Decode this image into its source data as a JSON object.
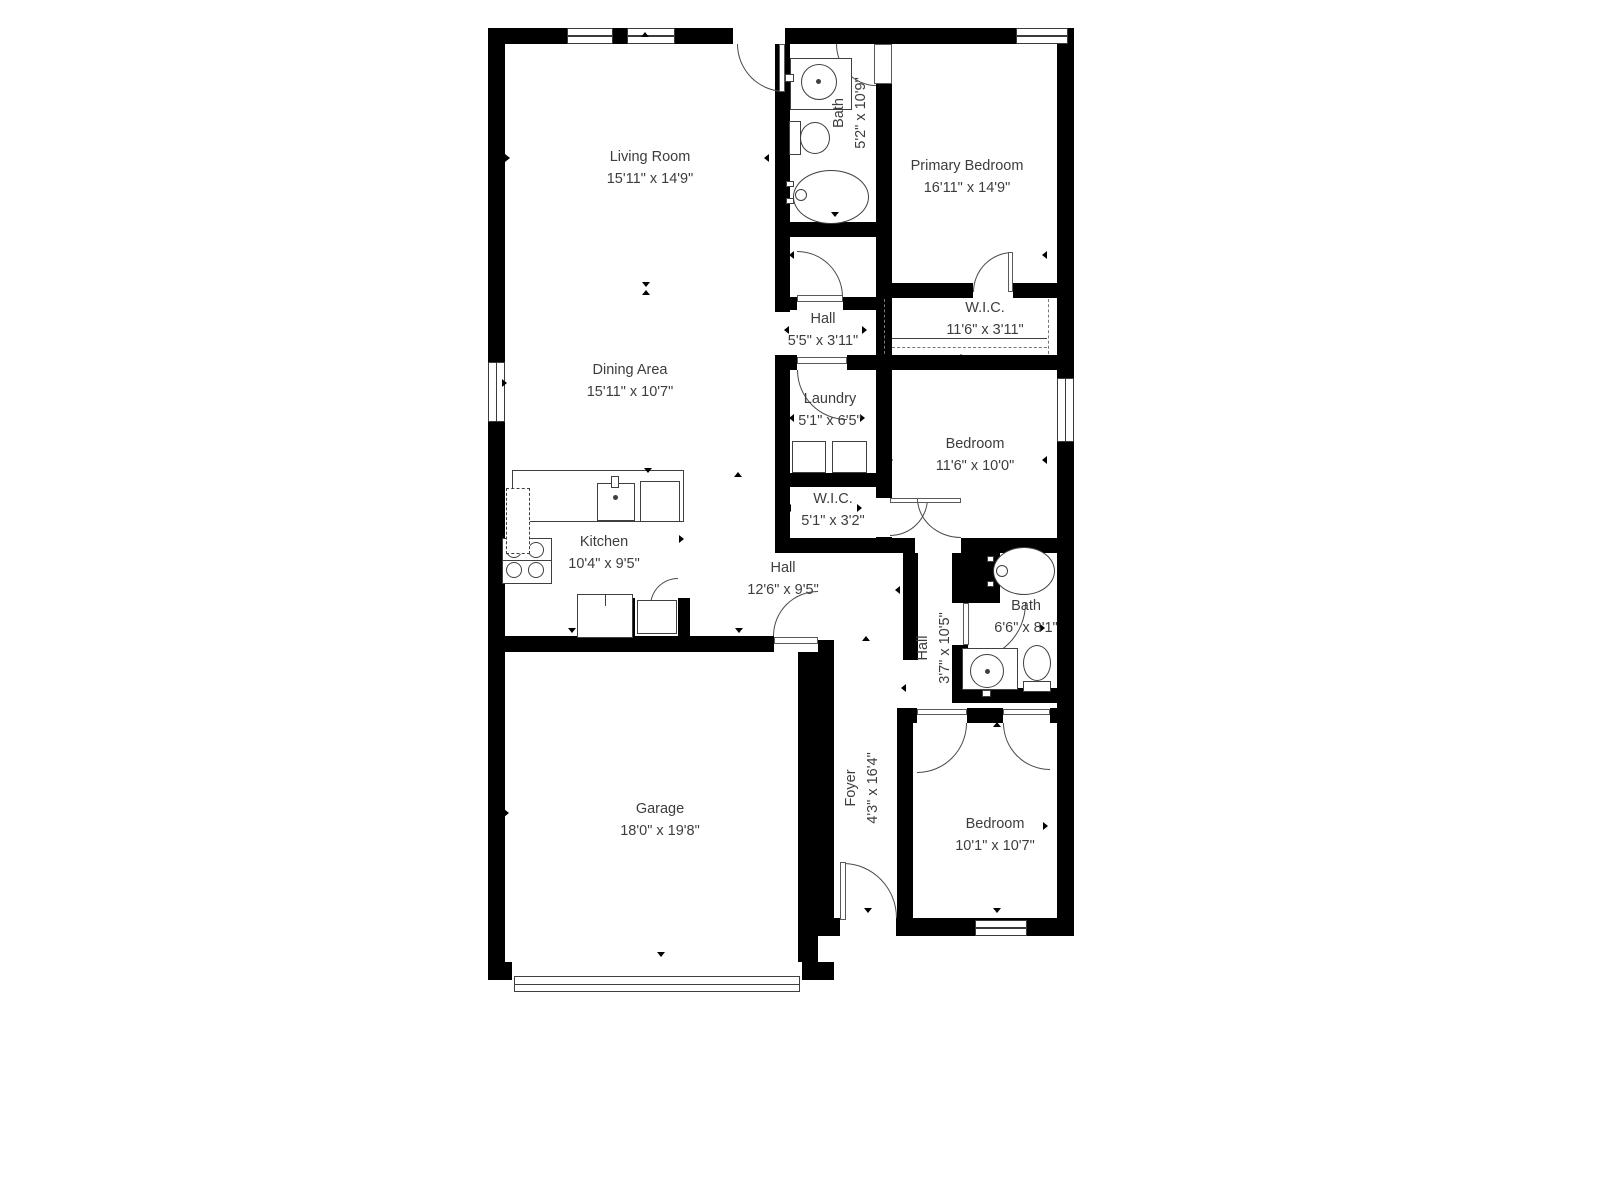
{
  "colors": {
    "wall": "#000000",
    "fixture_line": "#3f3f3f",
    "text": "#3d3d3d",
    "background": "#ffffff"
  },
  "floorplan": {
    "rooms": [
      {
        "name": "Living Room",
        "dims": "15'11\" x 14'9\"",
        "x": 650,
        "y": 168,
        "rot": 0
      },
      {
        "name": "Bath",
        "dims": "5'2\" x 10'9\"",
        "x": 850,
        "y": 113,
        "rot": -90
      },
      {
        "name": "Primary Bedroom",
        "dims": "16'11\" x 14'9\"",
        "x": 967,
        "y": 177,
        "rot": 0
      },
      {
        "name": "Hall",
        "dims": "5'5\" x 3'11\"",
        "x": 823,
        "y": 330,
        "rot": 0
      },
      {
        "name": "W.I.C.",
        "dims": "11'6\" x 3'11\"",
        "x": 985,
        "y": 319,
        "rot": 0
      },
      {
        "name": "Dining Area",
        "dims": "15'11\" x 10'7\"",
        "x": 630,
        "y": 381,
        "rot": 0
      },
      {
        "name": "Laundry",
        "dims": "5'1\" x 6'5\"",
        "x": 830,
        "y": 410,
        "rot": 0
      },
      {
        "name": "Bedroom",
        "dims": "11'6\" x 10'0\"",
        "x": 975,
        "y": 455,
        "rot": 0
      },
      {
        "name": "W.I.C.",
        "dims": "5'1\" x 3'2\"",
        "x": 833,
        "y": 510,
        "rot": 0
      },
      {
        "name": "Kitchen",
        "dims": "10'4\" x 9'5\"",
        "x": 604,
        "y": 553,
        "rot": 0
      },
      {
        "name": "Hall",
        "dims": "12'6\" x 9'5\"",
        "x": 783,
        "y": 579,
        "rot": 0
      },
      {
        "name": "Hall",
        "dims": "3'7\" x 10'5\"",
        "x": 934,
        "y": 648,
        "rot": -90
      },
      {
        "name": "Bath",
        "dims": "6'6\" x 8'1\"",
        "x": 1026,
        "y": 617,
        "rot": 0
      },
      {
        "name": "Garage",
        "dims": "18'0\" x 19'8\"",
        "x": 660,
        "y": 820,
        "rot": 0
      },
      {
        "name": "Foyer",
        "dims": "4'3\" x 16'4\"",
        "x": 862,
        "y": 788,
        "rot": -90
      },
      {
        "name": "Bedroom",
        "dims": "10'1\" x 10'7\"",
        "x": 995,
        "y": 835,
        "rot": 0
      }
    ],
    "walls": [
      [
        488,
        28,
        586,
        16
      ],
      [
        488,
        28,
        17,
        952
      ],
      [
        1057,
        28,
        17,
        908
      ],
      [
        488,
        962,
        346,
        18
      ],
      [
        818,
        918,
        256,
        18
      ],
      [
        775,
        44,
        15,
        268
      ],
      [
        775,
        370,
        15,
        175
      ],
      [
        775,
        355,
        282,
        15
      ],
      [
        775,
        222,
        117,
        15
      ],
      [
        876,
        84,
        16,
        414
      ],
      [
        876,
        537,
        16,
        16
      ],
      [
        790,
        297,
        86,
        13
      ],
      [
        876,
        283,
        181,
        15
      ],
      [
        775,
        473,
        117,
        14
      ],
      [
        775,
        538,
        101,
        15
      ],
      [
        876,
        538,
        181,
        15
      ],
      [
        903,
        553,
        15,
        107
      ],
      [
        952,
        545,
        48,
        58
      ],
      [
        952,
        645,
        16,
        58
      ],
      [
        952,
        688,
        105,
        15
      ],
      [
        897,
        708,
        160,
        15
      ],
      [
        897,
        708,
        16,
        212
      ],
      [
        818,
        640,
        16,
        280
      ],
      [
        798,
        652,
        20,
        310
      ],
      [
        505,
        636,
        313,
        16
      ],
      [
        623,
        598,
        12,
        38
      ],
      [
        678,
        598,
        12,
        38
      ]
    ],
    "openings": [
      [
        733,
        28,
        52,
        16
      ],
      [
        973,
        283,
        40,
        15
      ],
      [
        797,
        297,
        46,
        13
      ],
      [
        797,
        355,
        50,
        15
      ],
      [
        915,
        538,
        46,
        15
      ],
      [
        774,
        636,
        44,
        16
      ],
      [
        917,
        708,
        50,
        15
      ],
      [
        1003,
        708,
        47,
        15
      ],
      [
        840,
        918,
        56,
        18
      ],
      [
        512,
        962,
        290,
        18
      ]
    ],
    "windows": [
      [
        567,
        28,
        46,
        16
      ],
      [
        627,
        28,
        48,
        16
      ],
      [
        1016,
        28,
        52,
        16
      ],
      [
        488,
        362,
        17,
        60
      ],
      [
        1057,
        378,
        17,
        64
      ],
      [
        975,
        920,
        52,
        16
      ]
    ],
    "doors": [
      {
        "x": 737,
        "y": 44,
        "w": 48,
        "h": 48,
        "c": "bl"
      },
      {
        "x": 836,
        "y": 44,
        "w": 40,
        "h": 42,
        "c": "bl"
      },
      {
        "x": 973,
        "y": 252,
        "w": 40,
        "h": 40,
        "c": "tl"
      },
      {
        "x": 797,
        "y": 251,
        "w": 46,
        "h": 46,
        "c": "tr"
      },
      {
        "x": 797,
        "y": 370,
        "w": 50,
        "h": 50,
        "c": "bl"
      },
      {
        "x": 890,
        "y": 498,
        "w": 38,
        "h": 38,
        "c": "br"
      },
      {
        "x": 917,
        "y": 498,
        "w": 44,
        "h": 40,
        "c": "bl"
      },
      {
        "x": 773,
        "y": 591,
        "w": 45,
        "h": 45,
        "c": "tl"
      },
      {
        "x": 650,
        "y": 578,
        "w": 28,
        "h": 28,
        "c": "tl"
      },
      {
        "x": 968,
        "y": 603,
        "w": 58,
        "h": 58,
        "c": "br"
      },
      {
        "x": 917,
        "y": 723,
        "w": 50,
        "h": 50,
        "c": "br"
      },
      {
        "x": 1003,
        "y": 723,
        "w": 47,
        "h": 47,
        "c": "bl"
      },
      {
        "x": 843,
        "y": 863,
        "w": 54,
        "h": 55,
        "c": "tr"
      }
    ],
    "leaves": [
      [
        779,
        44,
        6,
        48
      ],
      [
        874,
        44,
        18,
        40
      ],
      [
        1008,
        252,
        5,
        40
      ],
      [
        797,
        295,
        46,
        7
      ],
      [
        797,
        357,
        50,
        7
      ],
      [
        890,
        498,
        38,
        5
      ],
      [
        917,
        498,
        44,
        5
      ],
      [
        774,
        637,
        44,
        7
      ],
      [
        963,
        603,
        6,
        42
      ],
      [
        840,
        862,
        6,
        58
      ],
      [
        917,
        709,
        50,
        6
      ],
      [
        1003,
        709,
        47,
        6
      ]
    ],
    "fixtures": [
      {
        "t": "rect",
        "x": 790,
        "y": 58,
        "w": 62,
        "h": 52
      },
      {
        "t": "circle",
        "x": 801,
        "y": 64,
        "d": 36
      },
      {
        "t": "dot",
        "x": 816,
        "y": 79,
        "d": 5
      },
      {
        "t": "rect",
        "x": 785,
        "y": 74,
        "w": 9,
        "h": 8
      },
      {
        "t": "rect",
        "x": 789,
        "y": 121,
        "w": 12,
        "h": 34
      },
      {
        "t": "ellipse",
        "x": 800,
        "y": 122,
        "w": 30,
        "h": 32
      },
      {
        "t": "ellipse",
        "x": 793,
        "y": 170,
        "w": 76,
        "h": 54
      },
      {
        "t": "circle",
        "x": 795,
        "y": 189,
        "d": 12
      },
      {
        "t": "rect",
        "x": 786,
        "y": 181,
        "w": 8,
        "h": 6
      },
      {
        "t": "rect",
        "x": 786,
        "y": 198,
        "w": 8,
        "h": 6
      },
      {
        "t": "ellipse",
        "x": 993,
        "y": 547,
        "w": 62,
        "h": 48
      },
      {
        "t": "circle",
        "x": 996,
        "y": 565,
        "d": 12
      },
      {
        "t": "rect",
        "x": 987,
        "y": 556,
        "w": 7,
        "h": 6
      },
      {
        "t": "rect",
        "x": 987,
        "y": 581,
        "w": 7,
        "h": 6
      },
      {
        "t": "rect",
        "x": 962,
        "y": 648,
        "w": 56,
        "h": 42
      },
      {
        "t": "circle",
        "x": 970,
        "y": 654,
        "d": 34
      },
      {
        "t": "dot",
        "x": 985,
        "y": 669,
        "d": 5
      },
      {
        "t": "rect",
        "x": 982,
        "y": 690,
        "w": 9,
        "h": 7
      },
      {
        "t": "ellipse",
        "x": 1023,
        "y": 645,
        "w": 28,
        "h": 36
      },
      {
        "t": "rect",
        "x": 1023,
        "y": 681,
        "w": 28,
        "h": 11
      },
      {
        "t": "rect",
        "x": 792,
        "y": 441,
        "w": 34,
        "h": 32
      },
      {
        "t": "rect",
        "x": 832,
        "y": 441,
        "w": 35,
        "h": 32
      },
      {
        "t": "rect",
        "x": 512,
        "y": 470,
        "w": 172,
        "h": 52
      },
      {
        "t": "rect",
        "x": 597,
        "y": 483,
        "w": 38,
        "h": 38
      },
      {
        "t": "rect",
        "x": 611,
        "y": 476,
        "w": 8,
        "h": 12
      },
      {
        "t": "dot",
        "x": 613,
        "y": 495,
        "d": 5
      },
      {
        "t": "rect",
        "x": 640,
        "y": 481,
        "w": 40,
        "h": 41
      },
      {
        "t": "rect",
        "x": 502,
        "y": 538,
        "w": 50,
        "h": 46
      },
      {
        "t": "circle",
        "x": 506,
        "y": 542,
        "d": 16
      },
      {
        "t": "circle",
        "x": 528,
        "y": 542,
        "d": 16
      },
      {
        "t": "circle",
        "x": 506,
        "y": 562,
        "d": 16
      },
      {
        "t": "circle",
        "x": 528,
        "y": 562,
        "d": 16
      },
      {
        "t": "hline",
        "x": 502,
        "y": 560,
        "w": 50
      },
      {
        "t": "rect",
        "x": 506,
        "y": 488,
        "w": 24,
        "h": 66,
        "dash": true
      },
      {
        "t": "rect",
        "x": 577,
        "y": 594,
        "w": 56,
        "h": 44
      },
      {
        "t": "vline",
        "x": 605,
        "y": 594,
        "h": 12
      },
      {
        "t": "rect",
        "x": 637,
        "y": 600,
        "w": 40,
        "h": 34
      },
      {
        "t": "vline",
        "x": 884,
        "y": 299,
        "h": 55,
        "dash": true
      },
      {
        "t": "vline",
        "x": 1048,
        "y": 299,
        "h": 55,
        "dash": true
      },
      {
        "t": "hline",
        "x": 892,
        "y": 338,
        "w": 155
      },
      {
        "t": "hline",
        "x": 892,
        "y": 347,
        "w": 155,
        "dash": true
      },
      {
        "t": "rect",
        "x": 514,
        "y": 976,
        "w": 286,
        "h": 16
      },
      {
        "t": "hline",
        "x": 514,
        "y": 984,
        "w": 286
      }
    ],
    "markers": [
      [
        645,
        34,
        "u"
      ],
      [
        987,
        33,
        "u"
      ],
      [
        509,
        158,
        "r"
      ],
      [
        768,
        158,
        "l"
      ],
      [
        646,
        284,
        "d"
      ],
      [
        646,
        292,
        "u"
      ],
      [
        1046,
        255,
        "l"
      ],
      [
        961,
        290,
        "d"
      ],
      [
        961,
        356,
        "u"
      ],
      [
        788,
        330,
        "l"
      ],
      [
        866,
        330,
        "r"
      ],
      [
        793,
        255,
        "l"
      ],
      [
        793,
        418,
        "l"
      ],
      [
        864,
        418,
        "r"
      ],
      [
        506,
        383,
        "r"
      ],
      [
        892,
        460,
        "r"
      ],
      [
        1046,
        460,
        "l"
      ],
      [
        790,
        508,
        "l"
      ],
      [
        861,
        508,
        "r"
      ],
      [
        683,
        539,
        "r"
      ],
      [
        738,
        474,
        "u"
      ],
      [
        648,
        470,
        "d"
      ],
      [
        572,
        630,
        "d"
      ],
      [
        739,
        630,
        "d"
      ],
      [
        866,
        638,
        "u"
      ],
      [
        661,
        642,
        "u"
      ],
      [
        899,
        590,
        "l"
      ],
      [
        905,
        688,
        "l"
      ],
      [
        983,
        540,
        "d"
      ],
      [
        1044,
        628,
        "r"
      ],
      [
        508,
        813,
        "r"
      ],
      [
        818,
        813,
        "l"
      ],
      [
        661,
        954,
        "d"
      ],
      [
        868,
        910,
        "d"
      ],
      [
        997,
        724,
        "u"
      ],
      [
        997,
        910,
        "d"
      ],
      [
        909,
        826,
        "l"
      ],
      [
        1047,
        826,
        "r"
      ],
      [
        835,
        214,
        "d"
      ]
    ]
  }
}
